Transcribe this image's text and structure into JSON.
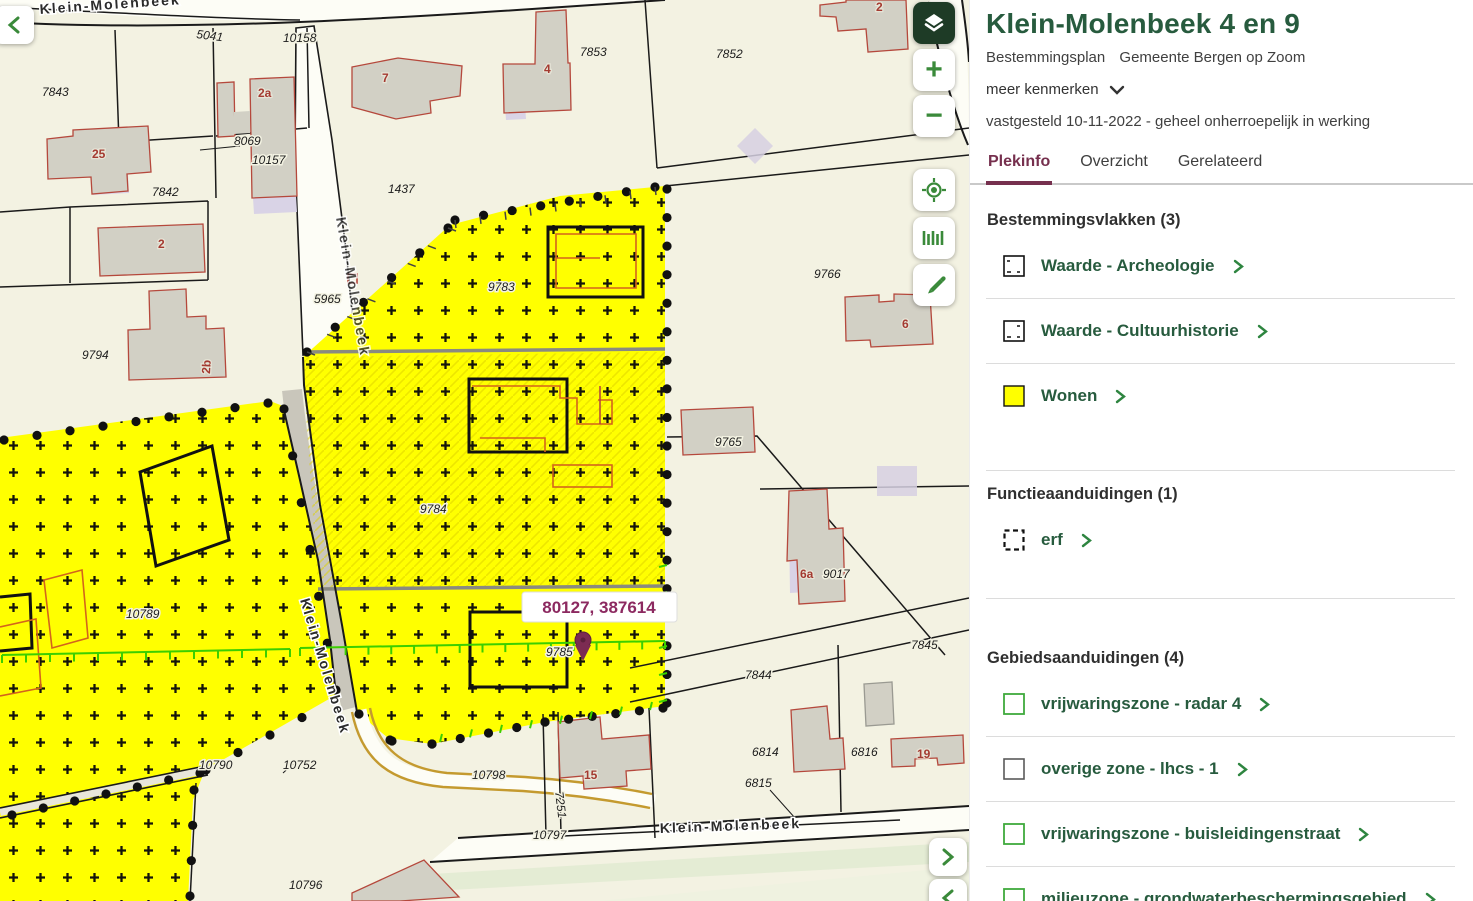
{
  "panel": {
    "title": "Klein-Molenbeek 4 en 9",
    "subtitle_type": "Bestemmingsplan",
    "subtitle_source": "Gemeente Bergen op Zoom",
    "more_link": "meer kenmerken",
    "status_line": "vastgesteld 10-11-2022 - geheel onherroepelijk in werking",
    "tabs": [
      {
        "label": "Plekinfo",
        "active": true
      },
      {
        "label": "Overzicht",
        "active": false
      },
      {
        "label": "Gerelateerd",
        "active": false
      }
    ],
    "sections": [
      {
        "heading": "Bestemmingsvlakken (3)",
        "items": [
          {
            "label": "Waarde - Archeologie",
            "icon": "archeologie-legend-square"
          },
          {
            "label": "Waarde - Cultuurhistorie",
            "icon": "cultuurhistorie-legend-square"
          },
          {
            "label": "Wonen",
            "icon": "wonen-yellow-square"
          }
        ]
      },
      {
        "heading": "Functieaanduidingen (1)",
        "items": [
          {
            "label": "erf",
            "icon": "dashed-black-square"
          }
        ]
      },
      {
        "heading": "Gebiedsaanduidingen (4)",
        "items": [
          {
            "label": "vrijwaringszone - radar 4",
            "icon": "green-outline-square"
          },
          {
            "label": "overige zone - lhcs - 1",
            "icon": "gray-outline-square"
          },
          {
            "label": "vrijwaringszone - buisleidingenstraat",
            "icon": "green-outline-square"
          },
          {
            "label": "milieuzone - grondwaterbeschermingsgebied",
            "icon": "green-outline-square"
          }
        ]
      }
    ]
  },
  "map": {
    "street": "Klein-Molenbeek",
    "coordinate_tooltip": "80127, 387614",
    "controls": {
      "zoom_in": "+",
      "zoom_out": "−"
    },
    "parcels": [
      "5041",
      "10158",
      "7843",
      "8069",
      "10157",
      "7842",
      "1437",
      "7853",
      "7852",
      "9766",
      "5965",
      "9783",
      "9794",
      "9765",
      "9017",
      "9784",
      "9785",
      "7845",
      "7844",
      "6814",
      "6816",
      "6815",
      "10789",
      "10790",
      "10752",
      "10798",
      "7251",
      "10797",
      "10796"
    ],
    "houses": [
      "25",
      "2a",
      "2",
      "7",
      "4",
      "2",
      "2b",
      "6",
      "6a",
      "15",
      "19"
    ]
  },
  "colors": {
    "accent_green": "#275b3e",
    "tab_maroon": "#76304e",
    "wonen_yellow": "#ffff00",
    "control_green": "#3a8a3a",
    "tooltip_magenta": "#8c2960"
  }
}
